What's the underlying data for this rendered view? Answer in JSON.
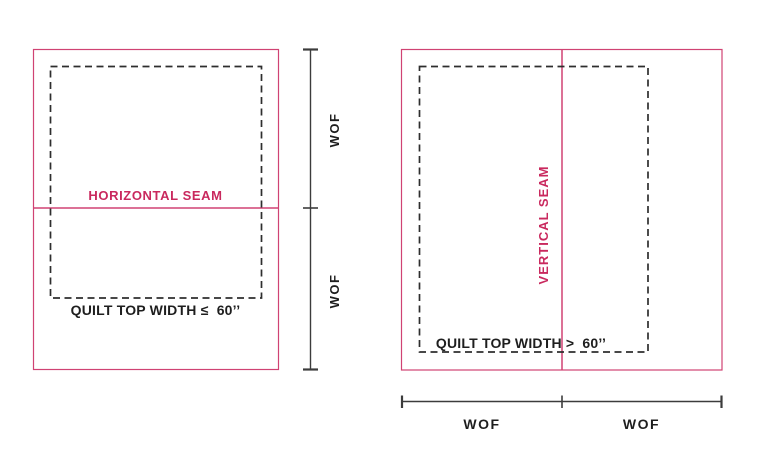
{
  "colors": {
    "pink_line": "#d04273",
    "pink_text": "#c9295e",
    "dark_text": "#1e1e1e",
    "dash_line": "#2e2e2e",
    "measure_line": "#3c3c3c",
    "background": "#ffffff"
  },
  "left_diagram": {
    "seam_label": "HORIZONTAL SEAM",
    "width_label": "QUILT TOP WIDTH ≤  60’’",
    "wof_top": "WOF",
    "wof_bottom": "WOF"
  },
  "right_diagram": {
    "seam_label": "VERTICAL SEAM",
    "width_label": "QUILT TOP WIDTH >  60’’",
    "wof_left": "WOF",
    "wof_right": "WOF"
  }
}
